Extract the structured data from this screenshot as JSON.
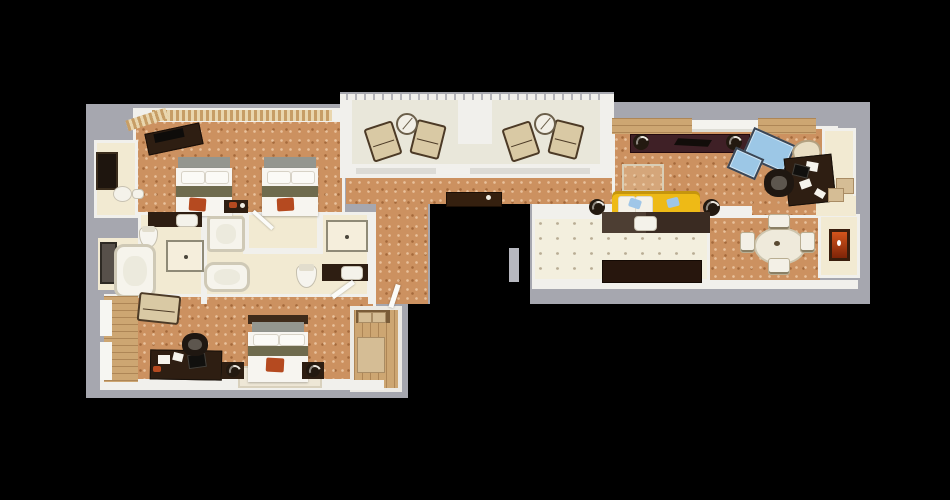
{
  "scene": {
    "kind": "3d-rendered-floorplan",
    "view": "top-down",
    "background": "#000000",
    "layout": "long horizontal suite: twin bedroom and bathrooms on left wing, balcony and hallway in center, living room, kitchen and dining on right wing, open elevator-shaft notch in middle"
  },
  "palette": {
    "bg": "#000000",
    "slab": "#a6a7af",
    "wall": "#f1f0ec",
    "carpet": "#cc9160",
    "cream": "#f2ead2",
    "tile": "#f3efde",
    "tile-dot": "#b9ad95",
    "balcony": "#e9e7da",
    "wood": "#cda672",
    "furn-dark": "#2e1e12",
    "furn-maroon": "#3f2026",
    "bed-white": "#f7f5f0",
    "bed-stripe": "#6f6b4e",
    "headboard-gray": "#94968f",
    "sofa-yellow": "#eeba16",
    "glass-blue": "#9cc7e6",
    "glass-edge": "#3c4654",
    "accent-red": "#b54a20",
    "fire-orange": "#d4551c",
    "lounge-tan": "#d9c9a4",
    "pillow-blue": "#9fc6e8"
  },
  "rooms": [
    {
      "name": "balcony",
      "furniture": [
        "lounge-chair",
        "lounge-chair",
        "round-table",
        "lounge-chair",
        "lounge-chair",
        "round-table",
        "railing"
      ]
    },
    {
      "name": "twin-bedroom",
      "furniture": [
        "angled-tv-dresser",
        "double-bed",
        "double-bed",
        "red-ottoman",
        "red-ottoman",
        "shared-nightstand",
        "window-blinds"
      ]
    },
    {
      "name": "wet-bar-alcove",
      "furniture": [
        "minibar-cabinet",
        "sink",
        "kettle"
      ]
    },
    {
      "name": "bathroom-1",
      "furniture": [
        "dark-vanity-with-sink",
        "toilet",
        "glass-shower",
        "bathtub",
        "mirror-panel"
      ]
    },
    {
      "name": "bathroom-2",
      "furniture": [
        "shower-tray",
        "bathtub"
      ]
    },
    {
      "name": "bathroom-3",
      "furniture": [
        "glass-shower",
        "toilet",
        "dark-vanity-with-sink"
      ]
    },
    {
      "name": "master-bedroom",
      "furniture": [
        "chaise-lounge",
        "writing-desk",
        "desk-chair",
        "laptop",
        "king-bed",
        "red-bench",
        "rug",
        "speaker-side-table",
        "speaker-side-table",
        "window-bay"
      ]
    },
    {
      "name": "entry-foyer",
      "furniture": [
        "closet-shelf",
        "luggage-box",
        "door-leaf",
        "door-leaf"
      ]
    },
    {
      "name": "hallway",
      "furniture": [
        "console-table",
        "shaft-door"
      ]
    },
    {
      "name": "living-room",
      "furniture": [
        "media-console",
        "speaker",
        "speaker",
        "yellow-sofa",
        "blue-pillow",
        "blue-pillow",
        "side-table",
        "side-table",
        "glass-coffee-table",
        "glass-coffee-table",
        "armchair",
        "office-desk",
        "office-chair",
        "rug"
      ]
    },
    {
      "name": "kitchen",
      "furniture": [
        "counter-with-sink",
        "credenza"
      ]
    },
    {
      "name": "dining-room",
      "furniture": [
        "round-dining-table",
        "dining-chair",
        "dining-chair",
        "dining-chair",
        "dining-chair",
        "fireplace"
      ]
    },
    {
      "name": "closet",
      "furniture": [
        "storage-box",
        "storage-box"
      ]
    }
  ]
}
